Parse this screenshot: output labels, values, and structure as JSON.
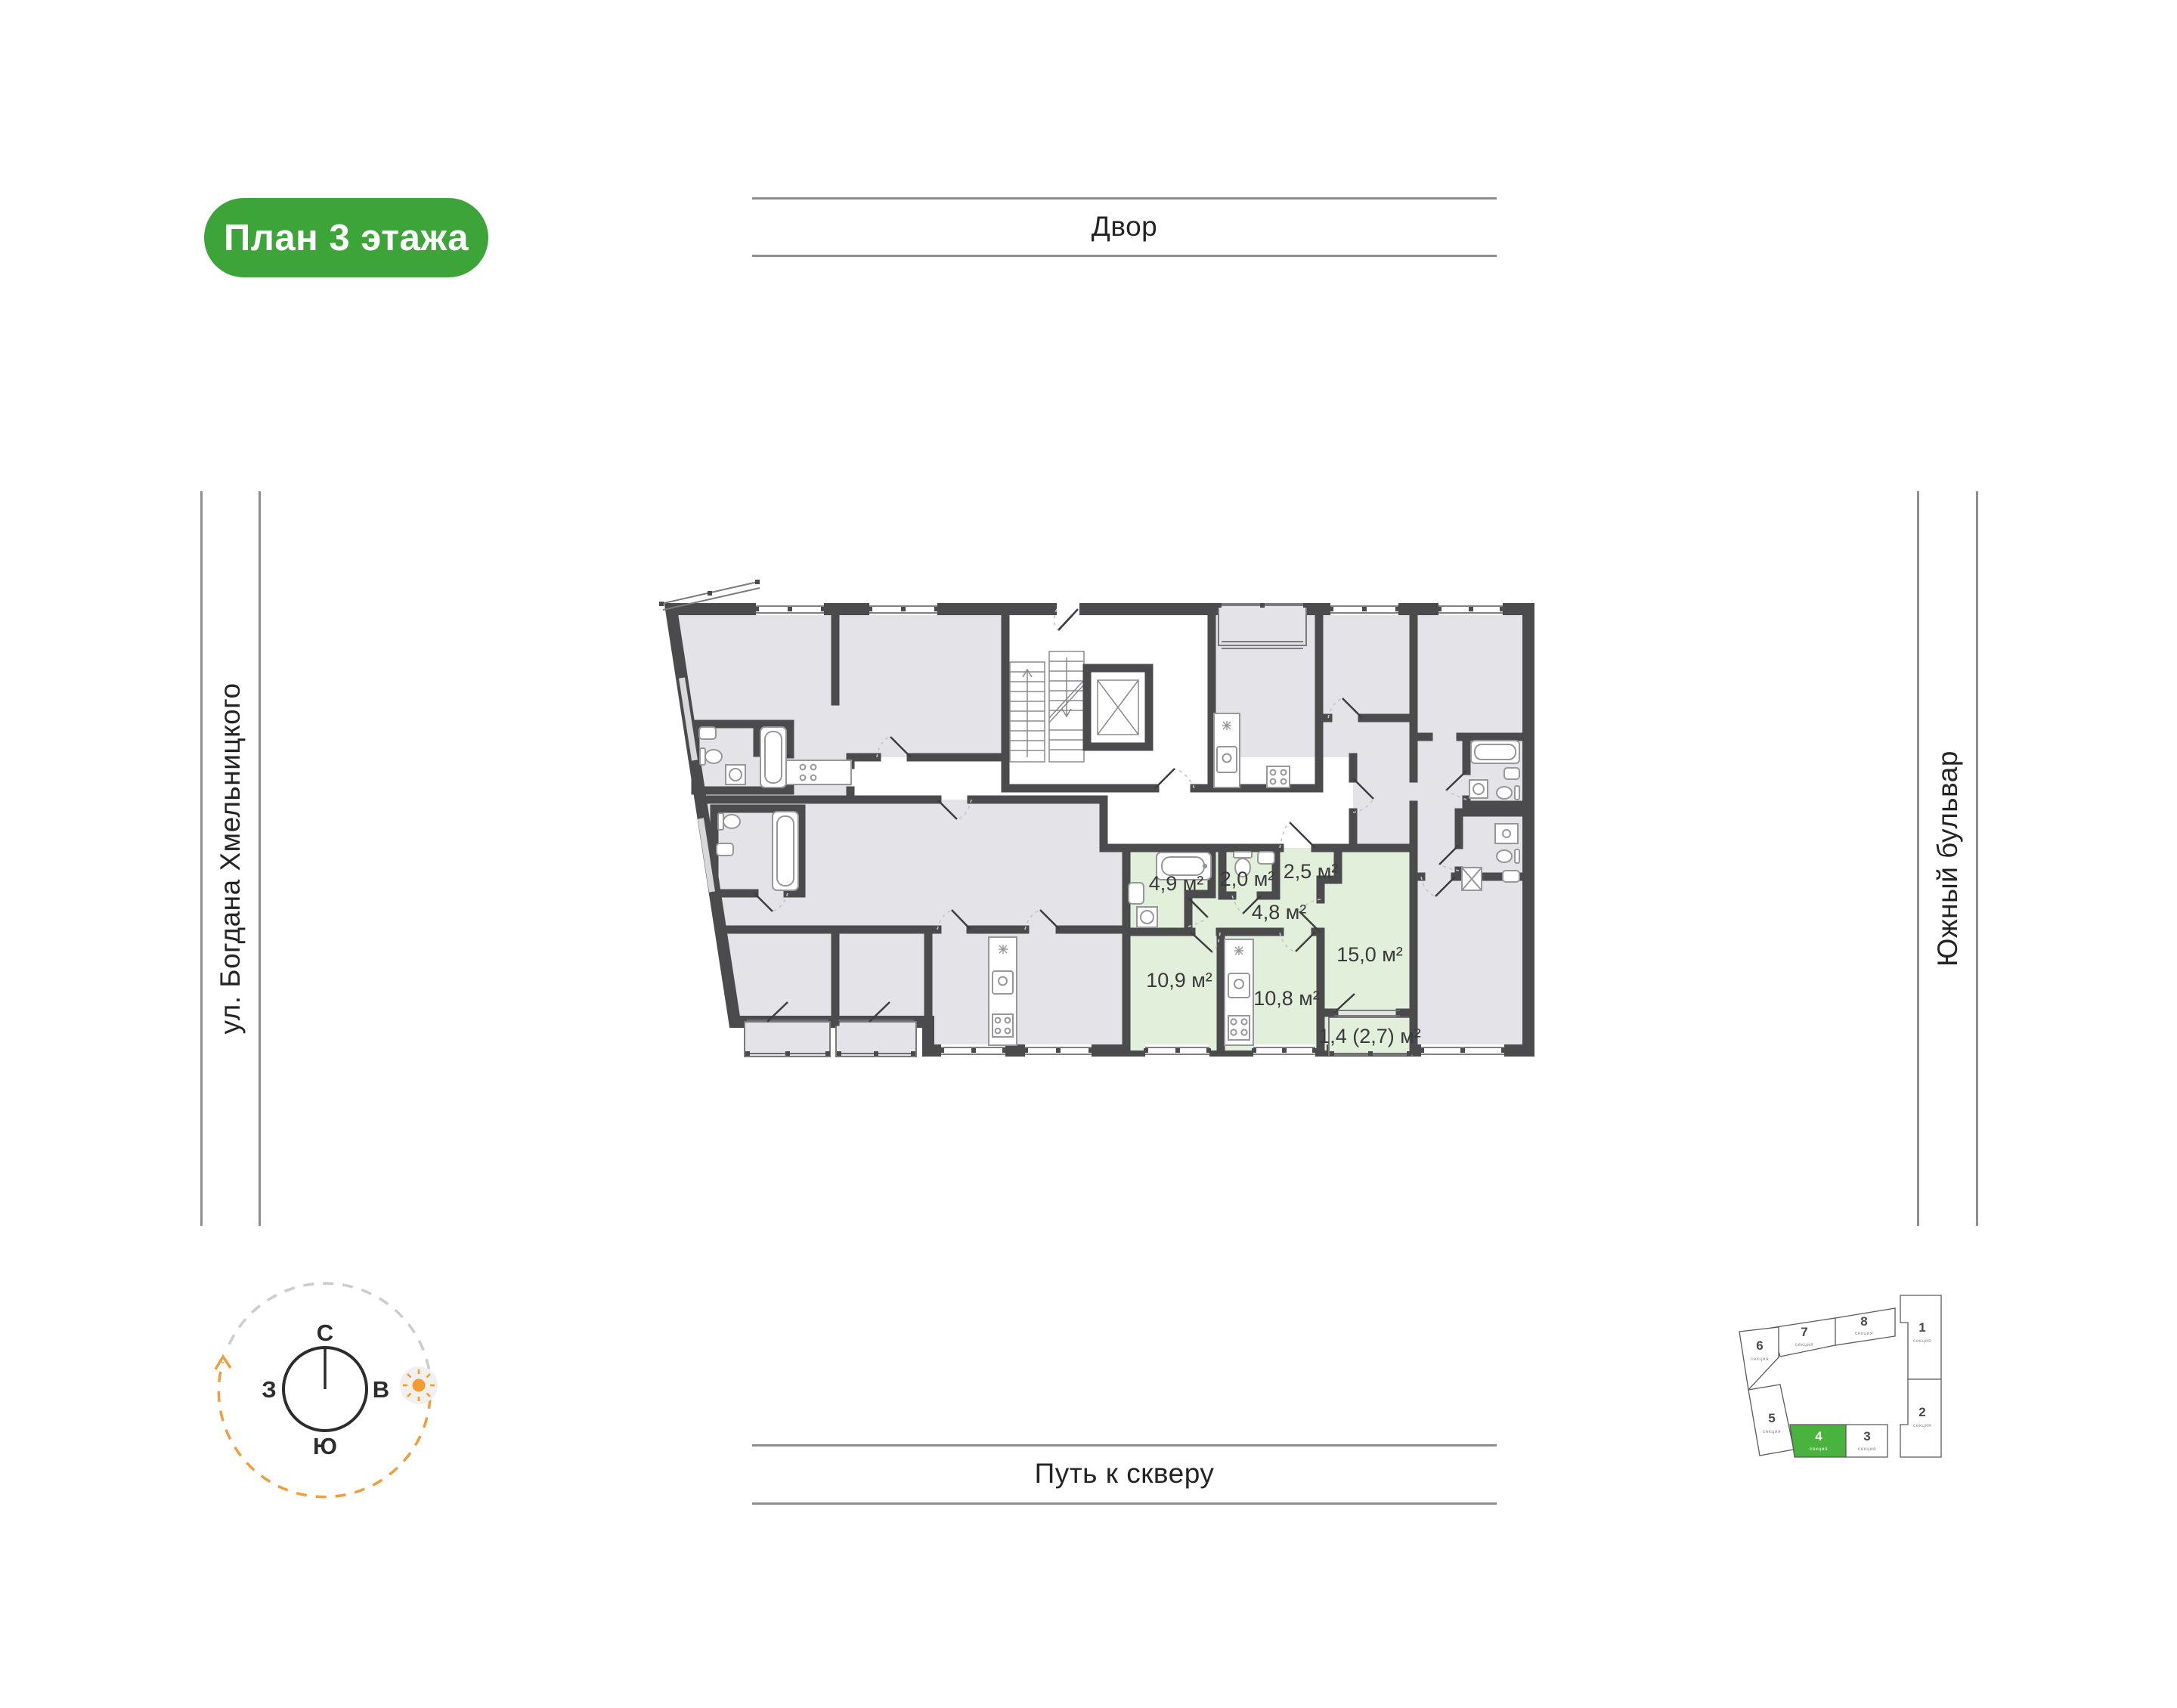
{
  "badge": {
    "label": "План 3 этажа"
  },
  "surroundings": {
    "top": "Двор",
    "left": "ул. Богдана Хмельницкого",
    "right": "Южный бульвар",
    "bottom": "Путь к скверу"
  },
  "compass": {
    "north": "С",
    "east": "В",
    "south": "Ю",
    "west": "З"
  },
  "plan": {
    "floor": "3",
    "rooms": [
      {
        "name": "bathroom",
        "area": "4,9 м²"
      },
      {
        "name": "wc",
        "area": "2,0 м²"
      },
      {
        "name": "wardrobe",
        "area": "2,5 м²"
      },
      {
        "name": "hallway",
        "area": "4,8 м²"
      },
      {
        "name": "living-room",
        "area": "15,0 м²"
      },
      {
        "name": "bedroom",
        "area": "10,9 м²"
      },
      {
        "name": "kitchen",
        "area": "10,8 м²"
      },
      {
        "name": "balcony",
        "area": "1,4 (2,7) м²"
      }
    ]
  },
  "minimap": {
    "sections": [
      {
        "number": "1",
        "label": "секция",
        "highlighted": false
      },
      {
        "number": "2",
        "label": "секция",
        "highlighted": false
      },
      {
        "number": "3",
        "label": "секция",
        "highlighted": false
      },
      {
        "number": "4",
        "label": "секция",
        "highlighted": true
      },
      {
        "number": "5",
        "label": "секция",
        "highlighted": false
      },
      {
        "number": "6",
        "label": "секция",
        "highlighted": false
      },
      {
        "number": "7",
        "label": "секция",
        "highlighted": false
      },
      {
        "number": "8",
        "label": "секция",
        "highlighted": false
      }
    ]
  },
  "colors": {
    "badge_green": "#3ca438",
    "minimap_green": "#4ab33e",
    "highlight_green": "#e2efdb",
    "room_gray": "#e4e4e8",
    "wall": "#4b4b4d",
    "compass_orange": "#f09d3c"
  }
}
